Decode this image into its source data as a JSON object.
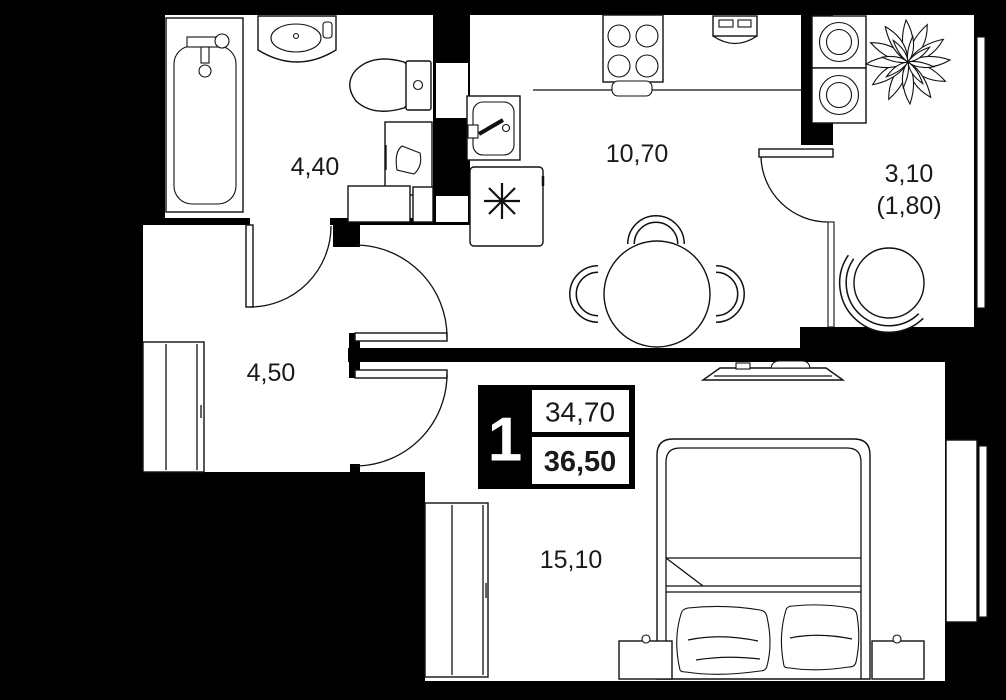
{
  "plan": {
    "colors": {
      "background": "#000000",
      "floor": "#ffffff",
      "line": "#111111"
    },
    "rooms": {
      "bathroom": {
        "area": "4,40"
      },
      "kitchen": {
        "area": "10,70"
      },
      "balcony": {
        "area": "3,10",
        "area_reduced": "(1,80)"
      },
      "hallway": {
        "area": "4,50"
      },
      "living_room": {
        "area": "15,10"
      }
    },
    "badge": {
      "rooms_count": "1",
      "area_main": "34,70",
      "area_total": "36,50"
    }
  }
}
